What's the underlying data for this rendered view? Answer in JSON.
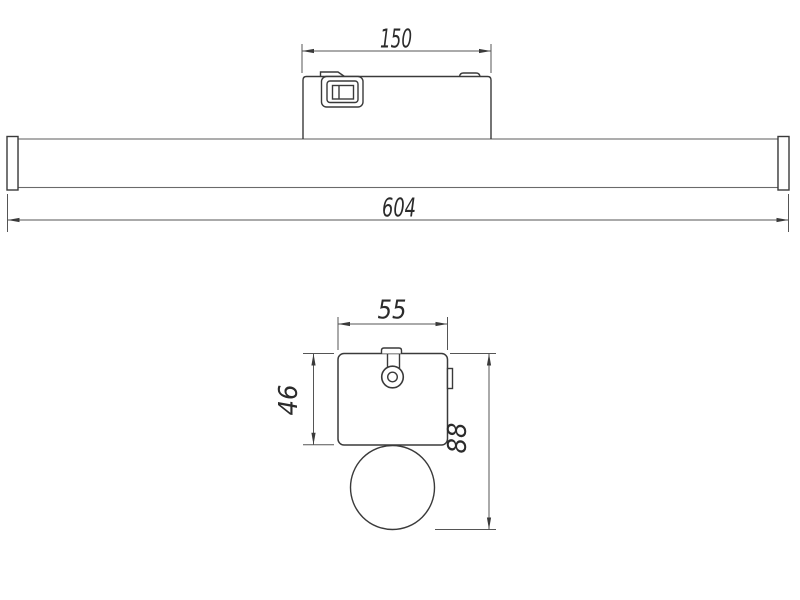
{
  "drawing": {
    "kind": "technical-dimension-drawing",
    "colors": {
      "line": "#3a3a3a",
      "dimension_line": "#555555",
      "text": "#2b2b2b",
      "background": "#ffffff"
    },
    "front_view": {
      "dim_box_width": "150",
      "dim_total_length": "604"
    },
    "side_view": {
      "dim_box_width": "55",
      "dim_box_height": "46",
      "dim_total_height": "88"
    }
  }
}
